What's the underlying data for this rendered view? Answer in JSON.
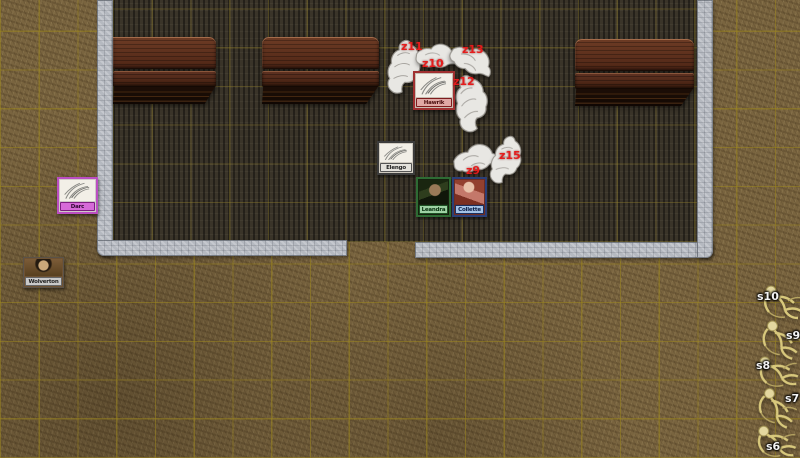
{
  "app": {
    "view": "virtual-tabletop-battle-map"
  },
  "tokens": [
    {
      "name": "Hawrik",
      "frame": "#a03030",
      "label_bg": "#e0a8a4"
    },
    {
      "name": "Elengo",
      "frame": "#3c3c3c",
      "label_bg": "#e4e2dc"
    },
    {
      "name": "Leandra",
      "frame": "#2e6b34",
      "label_bg": "#9ed2a4"
    },
    {
      "name": "Collette",
      "frame": "#2b3f77",
      "label_bg": "#a3c2e6"
    },
    {
      "name": "Darc",
      "frame": "#bb4ec2",
      "label_bg": "#d66ad8"
    },
    {
      "name": "Wolverton",
      "frame": "#5a5248",
      "label_bg": "#c9c9c9"
    }
  ],
  "wolves": [
    {
      "label": "z11"
    },
    {
      "label": "z10"
    },
    {
      "label": "z13"
    },
    {
      "label": "z12"
    },
    {
      "label": "z9"
    },
    {
      "label": "z15"
    }
  ],
  "skeletons": [
    {
      "label": "s10"
    },
    {
      "label": "s9"
    },
    {
      "label": "s8"
    },
    {
      "label": "s7"
    },
    {
      "label": "s6"
    }
  ],
  "colors": {
    "wolf_label": "#e51c1c",
    "skeleton_label": "#f4f4f4",
    "grid": "#9b851e",
    "ground": "#79643f",
    "room_floor": "#3a3429",
    "wall": "#b5b9c0",
    "table_wood": "#582c1b"
  }
}
